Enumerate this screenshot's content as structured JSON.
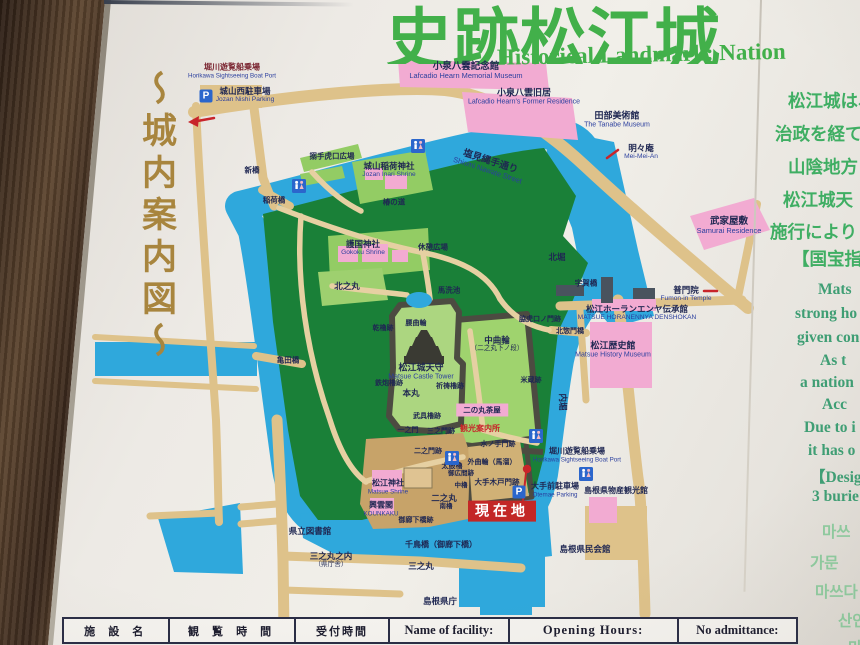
{
  "board": {
    "title_jp": "史跡松江城（",
    "title_en": "Historical Landmark: Nation",
    "side_title": "〜城内案内図〜",
    "right_jp_lines": [
      {
        "t": "松江城は、",
        "x": 788,
        "y": 88
      },
      {
        "t": "治政を経て",
        "x": 775,
        "y": 121
      },
      {
        "t": "山陰地方",
        "x": 788,
        "y": 154
      },
      {
        "t": "松江城天",
        "x": 783,
        "y": 187
      },
      {
        "t": "施行により",
        "x": 770,
        "y": 219
      },
      {
        "t": "【国宝指",
        "x": 792,
        "y": 246
      }
    ],
    "right_en_lines": [
      {
        "t": "Mats",
        "x": 818,
        "y": 281
      },
      {
        "t": "strong ho",
        "x": 795,
        "y": 305
      },
      {
        "t": "given con",
        "x": 797,
        "y": 329
      },
      {
        "t": "As t",
        "x": 820,
        "y": 352
      },
      {
        "t": "a nation",
        "x": 800,
        "y": 374
      },
      {
        "t": "Acc",
        "x": 822,
        "y": 396
      },
      {
        "t": "Due to i",
        "x": 804,
        "y": 419
      },
      {
        "t": "it has o",
        "x": 808,
        "y": 442
      },
      {
        "t": "【Desig",
        "x": 810,
        "y": 465
      },
      {
        "t": "3 burie",
        "x": 812,
        "y": 488
      }
    ],
    "right_kr_lines": [
      {
        "t": "마쓰",
        "x": 822,
        "y": 520
      },
      {
        "t": "가문",
        "x": 810,
        "y": 551
      },
      {
        "t": "마쓰다",
        "x": 815,
        "y": 580
      },
      {
        "t": "산인",
        "x": 838,
        "y": 609
      },
      {
        "t": "마",
        "x": 848,
        "y": 636
      }
    ]
  },
  "colors": {
    "title_green": "#42B04A",
    "text_green": "#3FAE63",
    "text_teal": "#3F9E74",
    "text_korean": "#8FCB9F",
    "calligraphy_brown": "#A8853E",
    "water": "#2FA8DC",
    "park_green": "#1A8038",
    "light_green": "#9FD36E",
    "road_tan": "#DEC28A",
    "pink": "#F2ABD2",
    "wall_gray": "#4C4B41",
    "red": "#C8242A",
    "frame_brown": "#4A3426",
    "label_navy": "#1F2752"
  },
  "map": {
    "parking_glyph": "P",
    "current_location": {
      "label": "現在地"
    },
    "wc_icons": [
      {
        "x": 418,
        "y": 146
      },
      {
        "x": 299,
        "y": 186
      },
      {
        "x": 536,
        "y": 436
      },
      {
        "x": 452,
        "y": 458
      },
      {
        "x": 586,
        "y": 474
      }
    ],
    "parking_icons": [
      {
        "x": 206,
        "y": 96
      },
      {
        "x": 519,
        "y": 492
      }
    ],
    "labels": [
      {
        "jp": "堀川遊覧船乗場",
        "en": "Horikawa Sightseeing Boat Port",
        "x": 232,
        "y": 71,
        "s": 8,
        "c": "#7A2430"
      },
      {
        "jp": "城山西駐車場",
        "en": "Jozan Nishi Parking",
        "x": 245,
        "y": 95,
        "s": 8.5
      },
      {
        "jp": "小泉八雲記念館",
        "en": "Lafcadio Hearn Memorial Museum",
        "x": 466,
        "y": 71,
        "s": 9.5
      },
      {
        "jp": "小泉八雲旧居",
        "en": "Lafcadio Hearn's Former Residence",
        "x": 524,
        "y": 97,
        "s": 9
      },
      {
        "jp": "田部美術館",
        "en": "The Tanabe Museum",
        "x": 617,
        "y": 120,
        "s": 9
      },
      {
        "jp": "武家屋敷",
        "en": "Samurai Residence",
        "x": 729,
        "y": 226,
        "s": 9.5
      },
      {
        "jp": "塩見縄手通り",
        "en": "Shiomi Nawate Street",
        "x": 489,
        "y": 166,
        "s": 9.5,
        "rot": 18
      },
      {
        "jp": "明々庵",
        "en": "Mei-Mei-An",
        "x": 641,
        "y": 152,
        "s": 8.5
      },
      {
        "jp": "普門院",
        "en": "Fumon-in Temple",
        "x": 686,
        "y": 294,
        "s": 8.5
      },
      {
        "jp": "松江ホーランエンヤ伝承館",
        "en": "MATSUE HORANENNYA DENSHOKAN",
        "x": 637,
        "y": 313,
        "s": 8.5
      },
      {
        "jp": "松江歴史館",
        "en": "Matsue History Museum",
        "x": 613,
        "y": 350,
        "s": 9
      },
      {
        "jp": "宇賀橋",
        "x": 586,
        "y": 283,
        "s": 7.5
      },
      {
        "jp": "新橋",
        "x": 252,
        "y": 170,
        "s": 7.5
      },
      {
        "jp": "稲荷橋",
        "x": 274,
        "y": 200,
        "s": 7.5
      },
      {
        "jp": "亀田橋",
        "x": 288,
        "y": 360,
        "s": 7.5
      },
      {
        "jp": "搦手虎口広場",
        "x": 332,
        "y": 156,
        "s": 7.5
      },
      {
        "jp": "城山稲荷神社",
        "en": "Jozan Inari Shrine",
        "x": 389,
        "y": 170,
        "s": 8.5
      },
      {
        "jp": "護国神社",
        "en": "Gokoku Shrine",
        "x": 363,
        "y": 248,
        "s": 8.5
      },
      {
        "jp": "北之丸",
        "x": 347,
        "y": 286,
        "s": 8.5
      },
      {
        "jp": "椿の道",
        "x": 394,
        "y": 202,
        "s": 7.5
      },
      {
        "jp": "休憩広場",
        "x": 433,
        "y": 247,
        "s": 7.5
      },
      {
        "jp": "北堀",
        "x": 557,
        "y": 257,
        "s": 8.5
      },
      {
        "jp": "内堀",
        "x": 563,
        "y": 402,
        "s": 8.5,
        "rot": 90
      },
      {
        "jp": "馬洗池",
        "x": 449,
        "y": 290,
        "s": 7.5
      },
      {
        "jp": "腰曲輪",
        "x": 416,
        "y": 324,
        "s": 7
      },
      {
        "jp": "脇虎口ノ門跡",
        "x": 540,
        "y": 320,
        "s": 7
      },
      {
        "jp": "北惣門橋",
        "x": 570,
        "y": 332,
        "s": 7
      },
      {
        "jp": "松江城天守",
        "en": "Matsue Castle Tower",
        "x": 421,
        "y": 372,
        "s": 9,
        "n": "label-matsue-castle-tower"
      },
      {
        "jp": "本丸",
        "x": 411,
        "y": 393,
        "s": 8.5
      },
      {
        "jp": "武具櫓跡",
        "x": 427,
        "y": 417,
        "s": 7
      },
      {
        "jp": "鉄炮櫓跡",
        "x": 389,
        "y": 384,
        "s": 7
      },
      {
        "jp": "乾櫓跡",
        "x": 383,
        "y": 329,
        "s": 7
      },
      {
        "jp": "祈祷櫓跡",
        "x": 450,
        "y": 387,
        "s": 7
      },
      {
        "jp": "一之門",
        "x": 408,
        "y": 431,
        "s": 7
      },
      {
        "jp": "三之門跡",
        "x": 441,
        "y": 432,
        "s": 7
      },
      {
        "jp": "中曲輪",
        "en": "（二之丸下ノ段）",
        "x": 497,
        "y": 344,
        "s": 8.5,
        "ec": "#1F2752"
      },
      {
        "jp": "米蔵跡",
        "x": 531,
        "y": 381,
        "s": 7
      },
      {
        "jp": "二の丸茶屋",
        "x": 482,
        "y": 410,
        "s": 7.5,
        "bg": "#F2ABD2"
      },
      {
        "jp": "観光案内所",
        "x": 480,
        "y": 429,
        "s": 8,
        "c": "#C8242A",
        "b": 1
      },
      {
        "jp": "二之門跡",
        "x": 428,
        "y": 452,
        "s": 7
      },
      {
        "jp": "太鼓櫓",
        "x": 452,
        "y": 467,
        "s": 7
      },
      {
        "jp": "水ノ手門跡",
        "x": 498,
        "y": 445,
        "s": 7
      },
      {
        "jp": "外曲輪（馬溜）",
        "x": 492,
        "y": 463,
        "s": 7
      },
      {
        "jp": "大手木戸門跡",
        "x": 497,
        "y": 482,
        "s": 7.5
      },
      {
        "jp": "御広間跡",
        "x": 461,
        "y": 474,
        "s": 6.5
      },
      {
        "jp": "中櫓",
        "x": 461,
        "y": 486,
        "s": 6.5
      },
      {
        "jp": "南櫓",
        "x": 446,
        "y": 507,
        "s": 6.5
      },
      {
        "jp": "松江神社",
        "en": "Matsue Shrine",
        "x": 388,
        "y": 487,
        "s": 8
      },
      {
        "jp": "興雲閣",
        "en": "KOUNKAKU",
        "x": 381,
        "y": 509,
        "s": 8
      },
      {
        "jp": "二之丸",
        "x": 444,
        "y": 498,
        "s": 8.5
      },
      {
        "jp": "御廊下橋跡",
        "x": 416,
        "y": 521,
        "s": 7
      },
      {
        "jp": "千鳥橋（御廊下橋）",
        "x": 441,
        "y": 545,
        "s": 8
      },
      {
        "jp": "三之丸",
        "x": 421,
        "y": 566,
        "s": 8.5
      },
      {
        "jp": "県立図書館",
        "x": 310,
        "y": 531,
        "s": 8.5
      },
      {
        "jp": "三之丸之内",
        "en": "（県庁舎）",
        "x": 331,
        "y": 560,
        "s": 8.5,
        "ec": "#1F2752"
      },
      {
        "jp": "島根県庁",
        "x": 440,
        "y": 601,
        "s": 8.5
      },
      {
        "jp": "島根県民会館",
        "x": 585,
        "y": 549,
        "s": 8.5
      },
      {
        "jp": "島根県物産観光館",
        "x": 616,
        "y": 491,
        "s": 8
      },
      {
        "jp": "大手前駐車場",
        "en": "Otemae Parking",
        "x": 555,
        "y": 490,
        "s": 8
      },
      {
        "jp": "堀川遊覧船乗場",
        "en": "Horikawa Sightseeing Boat Port",
        "x": 577,
        "y": 455,
        "s": 8
      },
      {
        "jp": "現在地",
        "x": 502,
        "y": 511,
        "s": 14,
        "c": "#FFFFFF",
        "bg": "#C32726",
        "b": 1,
        "ls": 4,
        "n": "current-location-badge"
      }
    ]
  },
  "table": {
    "cells": [
      "施 設 名",
      "観 覧 時 間",
      "受付時間",
      "Name of facility:",
      "Opening Hours:",
      "No admittance:"
    ]
  }
}
